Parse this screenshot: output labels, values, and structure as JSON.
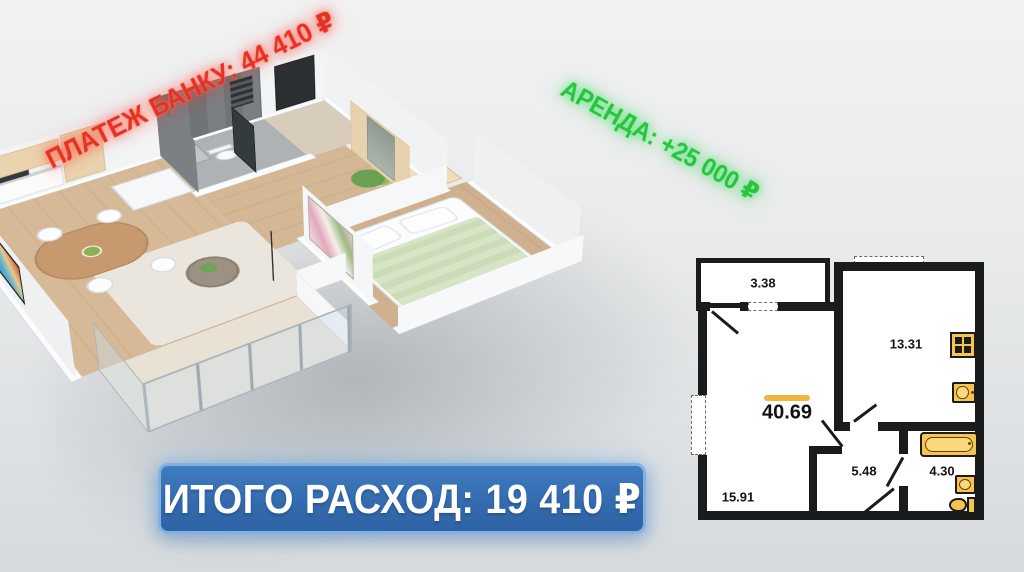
{
  "overlays": {
    "bank_payment": "ПЛАТЕЖ БАНКУ: 44 410 ₽",
    "rent": "АРЕНДА: +25 000 ₽",
    "total_expense": "ИТОГО РАСХОД: 19 410 ₽"
  },
  "colors": {
    "bank_payment_text": "#e63226",
    "rent_text": "#28c440",
    "banner_background": "#3570b4",
    "banner_border": "#82b2e2",
    "banner_text": "#ffffff",
    "plan_wall": "#1b1b1b",
    "plan_fixture_fill": "#f7c54f",
    "plan_area_highlight": "#f2b63e"
  },
  "floorplan": {
    "areas": {
      "balcony": "3.38",
      "kitchen": "13.31",
      "total": "40.69",
      "hallway": "5.48",
      "bathroom": "4.30",
      "living_room": "15.91"
    },
    "fixtures": [
      "stove",
      "kitchen-sink",
      "bathtub",
      "washbasin",
      "toilet"
    ]
  }
}
